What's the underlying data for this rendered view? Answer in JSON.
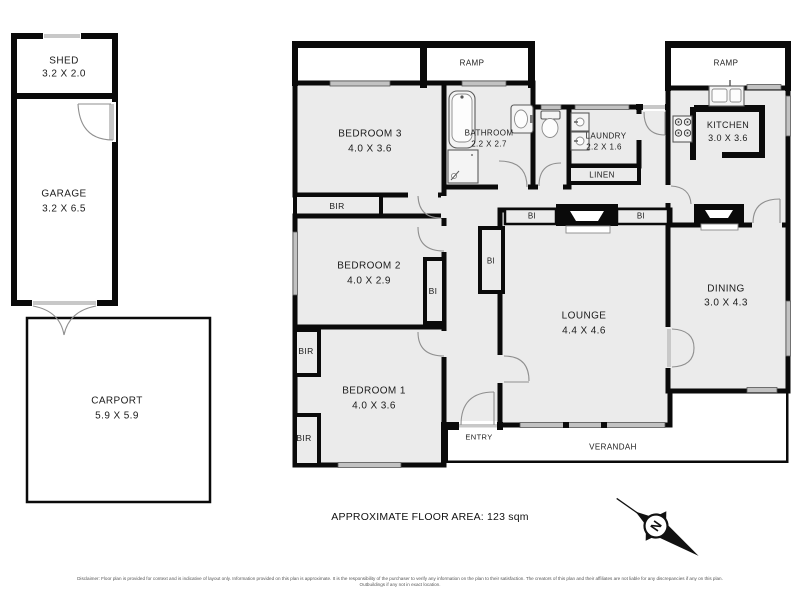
{
  "plan": {
    "rooms": {
      "shed": {
        "name": "SHED",
        "dims": "3.2 X 2.0"
      },
      "garage": {
        "name": "GARAGE",
        "dims": "3.2 X 6.5"
      },
      "carport": {
        "name": "CARPORT",
        "dims": "5.9 X 5.9"
      },
      "bedroom3": {
        "name": "BEDROOM 3",
        "dims": "4.0 X 3.6"
      },
      "bathroom": {
        "name": "BATHROOM",
        "dims": "2.2 X 2.7"
      },
      "laundry": {
        "name": "LAUNDRY",
        "dims": "2.2 X 1.6"
      },
      "kitchen": {
        "name": "KITCHEN",
        "dims": "3.0 X 3.6"
      },
      "bedroom2": {
        "name": "BEDROOM 2",
        "dims": "4.0 X 2.9"
      },
      "bedroom1": {
        "name": "BEDROOM 1",
        "dims": "4.0 X 3.6"
      },
      "lounge": {
        "name": "LOUNGE",
        "dims": "4.4 X 4.6"
      },
      "dining": {
        "name": "DINING",
        "dims": "3.0 X 4.3"
      }
    },
    "annotations": {
      "ramp": "RAMP",
      "linen": "LINEN",
      "entry": "ENTRY",
      "verandah": "VERANDAH",
      "bir": "BIR",
      "bi": "BI",
      "north": "N"
    },
    "footer": {
      "area_text": "APPROXIMATE FLOOR AREA: 123 sqm",
      "disclaimer": "Disclaimer: Floor plan is provided for context and is indicative of layout only. Information provided on this plan is approximate. It is the responsibility of the purchaser to verify any information on the plan to their satisfaction. The creators of this plan and their affiliates are not liable for any discrepancies if any on this plan. Outbuildings if any not in exact location."
    },
    "colors": {
      "wall": "#0a0a0a",
      "room_fill": "#ebebeb",
      "window": "#c2c2c2"
    }
  }
}
